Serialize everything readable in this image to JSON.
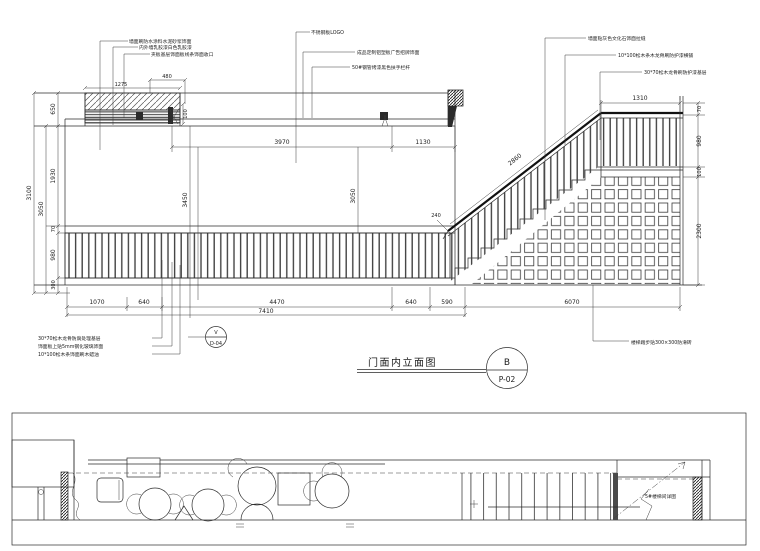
{
  "title": {
    "text": "门面内立面图",
    "ref_letter": "B",
    "ref_sheet": "P-02"
  },
  "detail_callout": {
    "letter": "V",
    "sheet": "D-04"
  },
  "annotations": {
    "top_left_1": "墙面刷防水涂料水泥砂浆饰面",
    "top_left_2": "内外墙乳胶漆白色乳胶漆",
    "top_left_3": "夹板基层饰面板线条饰面收口",
    "top_mid_1": "不锈钢板LOGO",
    "top_mid_2": "成品定制铝塑板广告招牌饰面",
    "top_mid_3": "50#钢管烤漆黑色扶手栏杆",
    "top_right_1": "墙面贴灰色文化石饰面拉缝",
    "top_right_2": "10*100松木条木龙骨刷防护漆横铺",
    "top_right_3": "30*70松木龙骨刷防护漆基层",
    "bottom_left_1": "30*70松木龙骨防腐处理基层",
    "bottom_left_2": "饰面板上贴5mm钢化玻璃饰面",
    "bottom_left_3": "10*100松木条饰面刷木蜡油",
    "bottom_right_1": "楼梯踏步贴300×300防滑砖"
  },
  "dims": {
    "h3100": "3100",
    "h3050": "3050",
    "v650": "650",
    "v1930": "1930",
    "v70": "70",
    "v980": "980",
    "v300": "300",
    "w1275": "1275",
    "w480": "480",
    "h100": "100",
    "w3970": "3970",
    "w1130": "1130",
    "m3450": "3450",
    "m3050": "3050",
    "s2860": "2860",
    "s240": "240",
    "p1310": "1310",
    "r70": "70",
    "r980": "980",
    "r100": "100",
    "r2300": "2300",
    "b1070": "1070",
    "b640a": "640",
    "b4470": "4470",
    "b640b": "640",
    "b590": "590",
    "b6070": "6070",
    "b7410": "7410"
  },
  "plan": {
    "stair_note": "5#楼梯间详图"
  }
}
